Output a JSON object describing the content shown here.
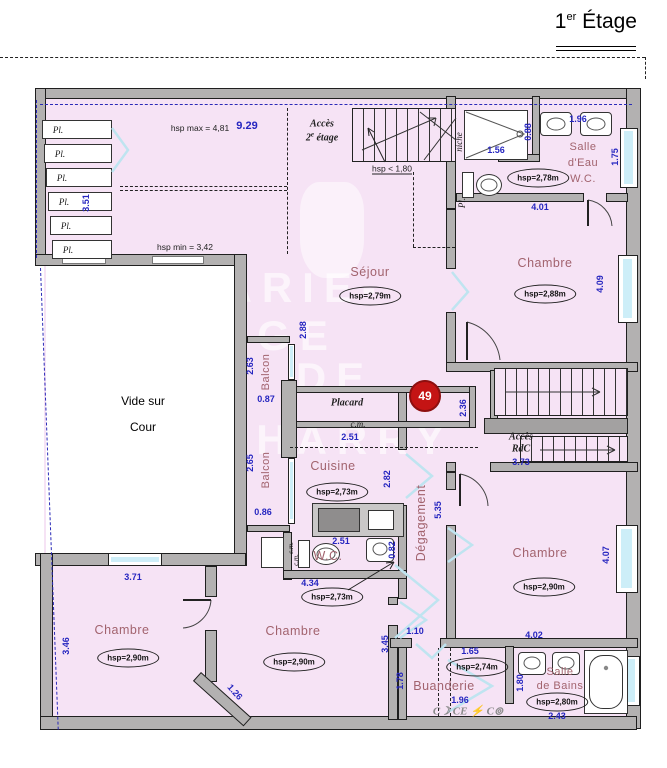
{
  "title": {
    "num": "1",
    "sup": "er",
    "word": "Étage"
  },
  "watermark": {
    "line1": "MARIE-ANGE",
    "line2": "DE",
    "line3": "CHARRY"
  },
  "badge": {
    "value": "49"
  },
  "rooms": {
    "sejour": {
      "name": "Séjour",
      "hsp": "hsp=2,79m"
    },
    "cuisine": {
      "name": "Cuisine",
      "hsp": "hsp=2,73m"
    },
    "chambre_tr": {
      "name": "Chambre",
      "hsp": "hsp=2,88m"
    },
    "chambre_r": {
      "name": "Chambre",
      "hsp": "hsp=2,90m"
    },
    "chambre_bl": {
      "name": "Chambre",
      "hsp": "hsp=2,90m"
    },
    "chambre_bm": {
      "name": "Chambre",
      "hsp": "hsp=2,90m"
    },
    "buanderie": {
      "name": "Buanderie",
      "hsp": "hsp=2,74m"
    },
    "wc": {
      "name": "W.C.",
      "hsp": "hsp=2,73m"
    },
    "salle_eau": {
      "line1": "Salle",
      "line2": "d'Eau",
      "line3": "W.C.",
      "hsp": "hsp=2,78m"
    },
    "salle_bains": {
      "line1": "Salle",
      "line2": "de Bains",
      "hsp": "hsp=2,80m"
    },
    "degagement": {
      "name": "Dégagement"
    },
    "balcon1": {
      "name": "Balcon"
    },
    "balcon2": {
      "name": "Balcon"
    },
    "placard": {
      "name": "Placard",
      "cm": "c.m."
    },
    "vide": {
      "line1": "Vide sur",
      "line2": "Cour"
    },
    "acces_rdc": {
      "line1": "Accès",
      "line2": "RdC"
    },
    "acces_2e": {
      "line1": "Accès",
      "line2_pre": "2",
      "line2_sup": "e",
      "line2_post": " étage"
    },
    "grenier": {
      "hsp_max": "hsp max = 4,81",
      "hsp_min": "hsp min = 3,42",
      "hsp_low": "hsp < 1,80"
    }
  },
  "labels": {
    "pl": "Pl.",
    "niche": "niche",
    "cm": "c.m.",
    "laundry": "C☽ CE ⚡ C⊚"
  },
  "dims": {
    "d929": "9.29",
    "d351": "3.51",
    "d156": "1.56",
    "d088": "0.88",
    "d196a": "1.96",
    "d175": "1.75",
    "d401": "4.01",
    "d409": "4.09",
    "d288": "2.88",
    "d263": "2.63",
    "d087": "0.87",
    "d251a": "2.51",
    "d236": "2.36",
    "d373": "3.73",
    "d265": "2.65",
    "d086": "0.86",
    "d282": "2.82",
    "d251b": "2.51",
    "d082": "0.82",
    "d434": "4.34",
    "d535": "5.35",
    "d407": "4.07",
    "d402": "4.02",
    "d371": "3.71",
    "d346": "3.46",
    "d126": "1.26",
    "d345": "3.45",
    "d110": "1.10",
    "d178": "1.78",
    "d165": "1.65",
    "d196b": "1.96",
    "d180": "1.80",
    "d243": "2.43"
  }
}
